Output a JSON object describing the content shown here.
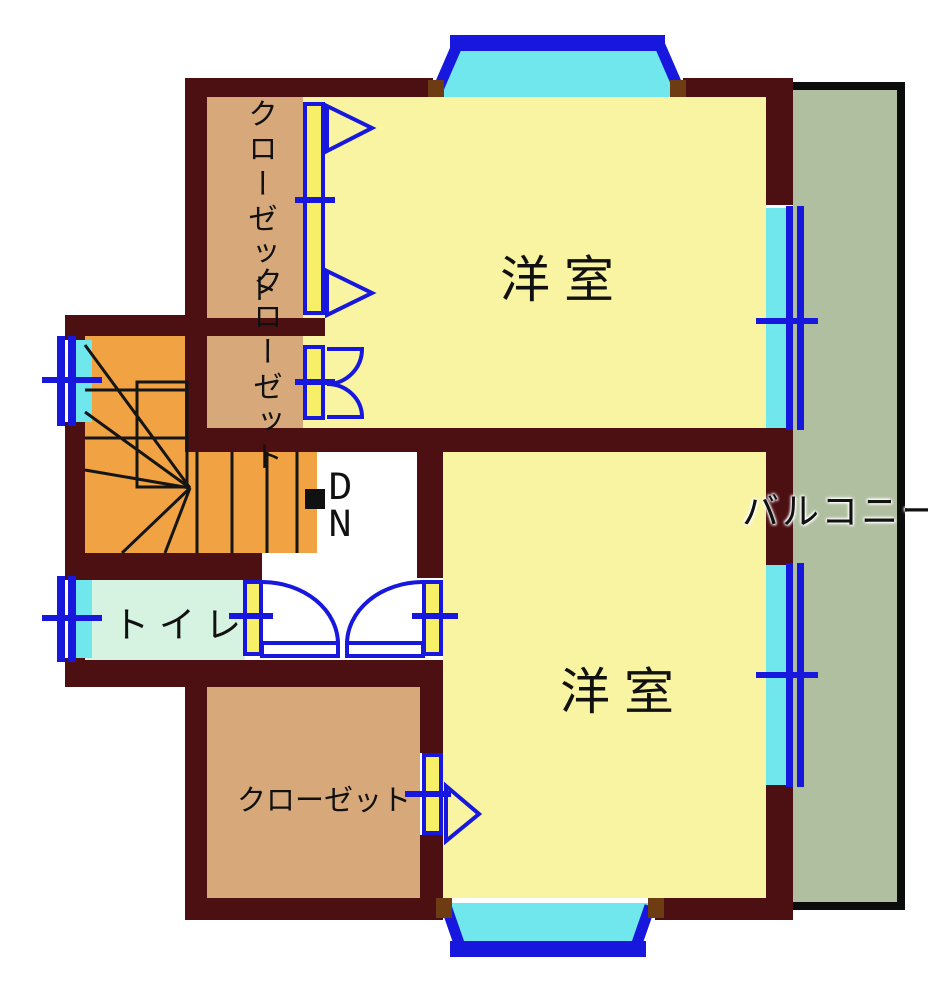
{
  "plan": {
    "rooms": {
      "western_room_top": "洋室",
      "western_room_bottom": "洋室",
      "closet_upper_vertical": "クローゼット",
      "closet_lower_vertical": "クローゼット",
      "closet_bottom": "クローゼット",
      "toilet": "トイレ",
      "balcony": "バルコニー",
      "stairs_down_line1": "D",
      "stairs_down_line2": "N"
    },
    "colors": {
      "wall": "#4d1012",
      "room_yellow": "#f8f4a2",
      "closet_tan": "#d7a87a",
      "stairs_orange": "#f1a343",
      "toilet_mint": "#d6f3e2",
      "balcony_green": "#b1bfa1",
      "glass_cyan": "#6fe7ec",
      "frame_blue": "#1717dd",
      "jamb_yellow": "#f6ef67"
    }
  }
}
